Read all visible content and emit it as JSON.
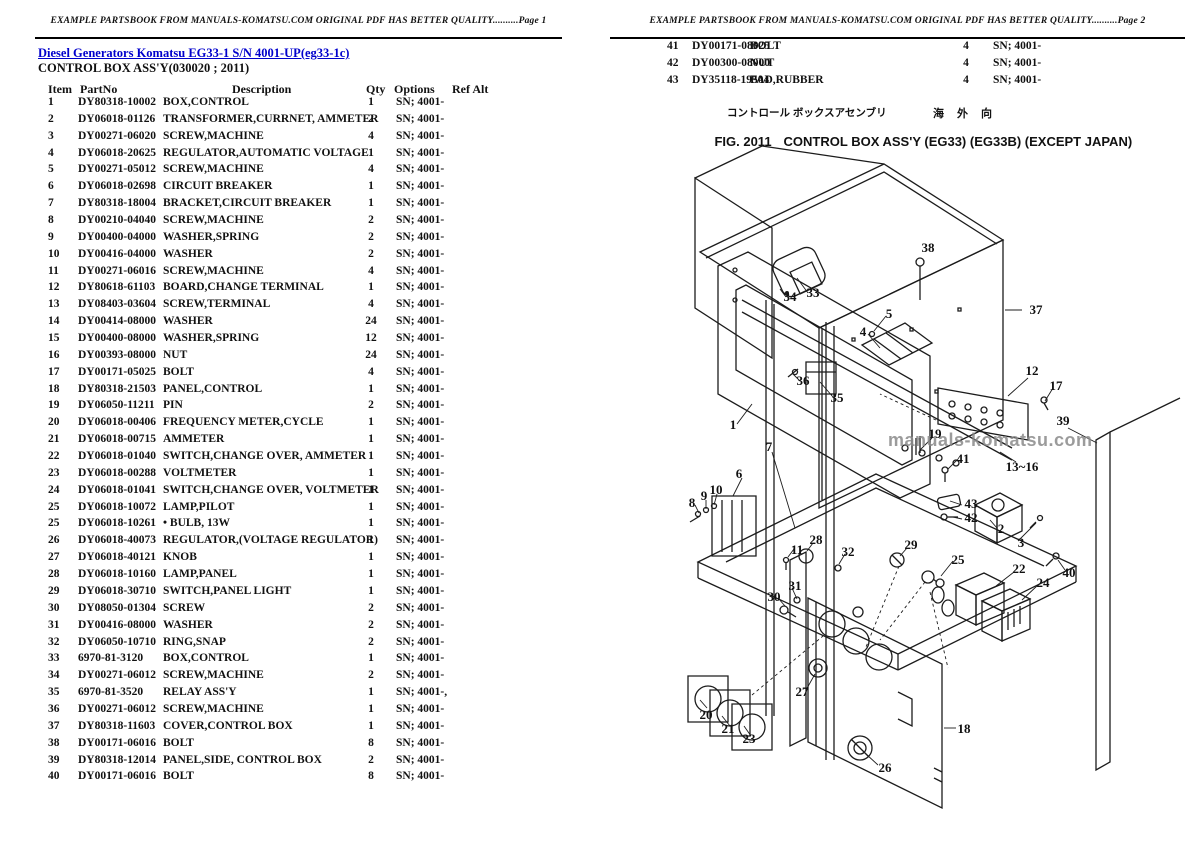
{
  "header_left": {
    "text": "EXAMPLE PARTSBOOK FROM MANUALS-KOMATSU.COM ORIGINAL PDF HAS BETTER QUALITY..........Page 1"
  },
  "header_right": {
    "text": "EXAMPLE PARTSBOOK FROM MANUALS-KOMATSU.COM ORIGINAL PDF HAS BETTER QUALITY..........Page 2"
  },
  "page1": {
    "title_link": "Diesel Generators Komatsu EG33-1 S/N 4001-UP(eg33-1c)",
    "subtitle": "CONTROL BOX ASS'Y(030020 ; 2011)",
    "columns": {
      "item": "Item",
      "partno": "PartNo",
      "description": "Description",
      "qty": "Qty",
      "options": "Options",
      "refalt": "Ref Alt"
    },
    "rows": [
      [
        "1",
        "DY80318-10002",
        "BOX,CONTROL",
        "1",
        "SN; 4001-"
      ],
      [
        "2",
        "DY06018-01126",
        "TRANSFORMER,CURRNET, AMMETER",
        "2",
        "SN; 4001-"
      ],
      [
        "3",
        "DY00271-06020",
        "SCREW,MACHINE",
        "4",
        "SN; 4001-"
      ],
      [
        "4",
        "DY06018-20625",
        "REGULATOR,AUTOMATIC VOLTAGE",
        "1",
        "SN; 4001-"
      ],
      [
        "5",
        "DY00271-05012",
        "SCREW,MACHINE",
        "4",
        "SN; 4001-"
      ],
      [
        "6",
        "DY06018-02698",
        "CIRCUIT BREAKER",
        "1",
        "SN; 4001-"
      ],
      [
        "7",
        "DY80318-18004",
        "BRACKET,CIRCUIT BREAKER",
        "1",
        "SN; 4001-"
      ],
      [
        "8",
        "DY00210-04040",
        "SCREW,MACHINE",
        "2",
        "SN; 4001-"
      ],
      [
        "9",
        "DY00400-04000",
        "WASHER,SPRING",
        "2",
        "SN; 4001-"
      ],
      [
        "10",
        "DY00416-04000",
        "WASHER",
        "2",
        "SN; 4001-"
      ],
      [
        "11",
        "DY00271-06016",
        "SCREW,MACHINE",
        "4",
        "SN; 4001-"
      ],
      [
        "12",
        "DY80618-61103",
        "BOARD,CHANGE TERMINAL",
        "1",
        "SN; 4001-"
      ],
      [
        "13",
        "DY08403-03604",
        "SCREW,TERMINAL",
        "4",
        "SN; 4001-"
      ],
      [
        "14",
        "DY00414-08000",
        "WASHER",
        "24",
        "SN; 4001-"
      ],
      [
        "15",
        "DY00400-08000",
        "WASHER,SPRING",
        "12",
        "SN; 4001-"
      ],
      [
        "16",
        "DY00393-08000",
        "NUT",
        "24",
        "SN; 4001-"
      ],
      [
        "17",
        "DY00171-05025",
        "BOLT",
        "4",
        "SN; 4001-"
      ],
      [
        "18",
        "DY80318-21503",
        "PANEL,CONTROL",
        "1",
        "SN; 4001-"
      ],
      [
        "19",
        "DY06050-11211",
        "PIN",
        "2",
        "SN; 4001-"
      ],
      [
        "20",
        "DY06018-00406",
        "FREQUENCY METER,CYCLE",
        "1",
        "SN; 4001-"
      ],
      [
        "21",
        "DY06018-00715",
        "AMMETER",
        "1",
        "SN; 4001-"
      ],
      [
        "22",
        "DY06018-01040",
        "SWITCH,CHANGE OVER, AMMETER",
        "1",
        "SN; 4001-"
      ],
      [
        "23",
        "DY06018-00288",
        "VOLTMETER",
        "1",
        "SN; 4001-"
      ],
      [
        "24",
        "DY06018-01041",
        "SWITCH,CHANGE OVER, VOLTMETER",
        "1",
        "SN; 4001-"
      ],
      [
        "25",
        "DY06018-10072",
        "LAMP,PILOT",
        "1",
        "SN; 4001-"
      ],
      [
        "25",
        "DY06018-10261",
        "• BULB, 13W",
        "1",
        "SN; 4001-"
      ],
      [
        "26",
        "DY06018-40073",
        "REGULATOR,(VOLTAGE REGULATOR)",
        "1",
        "SN; 4001-"
      ],
      [
        "27",
        "DY06018-40121",
        "KNOB",
        "1",
        "SN; 4001-"
      ],
      [
        "28",
        "DY06018-10160",
        "LAMP,PANEL",
        "1",
        "SN; 4001-"
      ],
      [
        "29",
        "DY06018-30710",
        "SWITCH,PANEL LIGHT",
        "1",
        "SN; 4001-"
      ],
      [
        "30",
        "DY08050-01304",
        "SCREW",
        "2",
        "SN; 4001-"
      ],
      [
        "31",
        "DY00416-08000",
        "WASHER",
        "2",
        "SN; 4001-"
      ],
      [
        "32",
        "DY06050-10710",
        "RING,SNAP",
        "2",
        "SN; 4001-"
      ],
      [
        "33",
        "6970-81-3120",
        "BOX,CONTROL",
        "1",
        "SN; 4001-"
      ],
      [
        "34",
        "DY00271-06012",
        "SCREW,MACHINE",
        "2",
        "SN; 4001-"
      ],
      [
        "35",
        "6970-81-3520",
        "RELAY ASS'Y",
        "1",
        "SN; 4001-,"
      ],
      [
        "36",
        "DY00271-06012",
        "SCREW,MACHINE",
        "1",
        "SN; 4001-"
      ],
      [
        "37",
        "DY80318-11603",
        "COVER,CONTROL BOX",
        "1",
        "SN; 4001-"
      ],
      [
        "38",
        "DY00171-06016",
        "BOLT",
        "8",
        "SN; 4001-"
      ],
      [
        "39",
        "DY80318-12014",
        "PANEL,SIDE, CONTROL BOX",
        "2",
        "SN; 4001-"
      ],
      [
        "40",
        "DY00171-06016",
        "BOLT",
        "8",
        "SN; 4001-"
      ]
    ]
  },
  "page2": {
    "rows": [
      [
        "41",
        "DY00171-08025",
        "BOLT",
        "4",
        "SN; 4001-"
      ],
      [
        "42",
        "DY00300-08000",
        "NUT",
        "4",
        "SN; 4001-"
      ],
      [
        "43",
        "DY35118-19504",
        "PAD,RUBBER",
        "4",
        "SN; 4001-"
      ]
    ],
    "figure": {
      "caption_jp_left": "コントロール ボックスアセンブリ",
      "caption_jp_right": "海外向",
      "fig_label": "FIG. 2011",
      "fig_title": "CONTROL BOX ASS'Y (EG33) (EG33B) (EXCEPT JAPAN)",
      "watermark": "manuals-komatsu.com",
      "callouts": [
        {
          "label": "38",
          "x": 928,
          "y": 252
        },
        {
          "label": "37",
          "x": 1036,
          "y": 314
        },
        {
          "label": "33",
          "x": 813,
          "y": 297
        },
        {
          "label": "34",
          "x": 790,
          "y": 301
        },
        {
          "label": "5",
          "x": 889,
          "y": 318
        },
        {
          "label": "4",
          "x": 863,
          "y": 336
        },
        {
          "label": "36",
          "x": 803,
          "y": 385
        },
        {
          "label": "35",
          "x": 837,
          "y": 402
        },
        {
          "label": "12",
          "x": 1032,
          "y": 375
        },
        {
          "label": "17",
          "x": 1056,
          "y": 390
        },
        {
          "label": "1",
          "x": 733,
          "y": 429
        },
        {
          "label": "39",
          "x": 1063,
          "y": 425
        },
        {
          "label": "19",
          "x": 935,
          "y": 438
        },
        {
          "label": "41",
          "x": 963,
          "y": 463
        },
        {
          "label": "13~16",
          "x": 1022,
          "y": 471
        },
        {
          "label": "7",
          "x": 769,
          "y": 451
        },
        {
          "label": "6",
          "x": 739,
          "y": 478
        },
        {
          "label": "9",
          "x": 704,
          "y": 500
        },
        {
          "label": "10",
          "x": 716,
          "y": 494
        },
        {
          "label": "8",
          "x": 692,
          "y": 507
        },
        {
          "label": "11",
          "x": 797,
          "y": 554
        },
        {
          "label": "28",
          "x": 816,
          "y": 544
        },
        {
          "label": "32",
          "x": 848,
          "y": 556
        },
        {
          "label": "29",
          "x": 911,
          "y": 549
        },
        {
          "label": "25",
          "x": 958,
          "y": 564
        },
        {
          "label": "43",
          "x": 971,
          "y": 508
        },
        {
          "label": "42",
          "x": 971,
          "y": 522
        },
        {
          "label": "2",
          "x": 1001,
          "y": 533
        },
        {
          "label": "3",
          "x": 1021,
          "y": 547
        },
        {
          "label": "22",
          "x": 1019,
          "y": 573
        },
        {
          "label": "24",
          "x": 1043,
          "y": 587
        },
        {
          "label": "40",
          "x": 1069,
          "y": 577
        },
        {
          "label": "30",
          "x": 774,
          "y": 601
        },
        {
          "label": "31",
          "x": 795,
          "y": 590
        },
        {
          "label": "27",
          "x": 802,
          "y": 696
        },
        {
          "label": "20",
          "x": 706,
          "y": 719
        },
        {
          "label": "21",
          "x": 728,
          "y": 733
        },
        {
          "label": "23",
          "x": 749,
          "y": 743
        },
        {
          "label": "26",
          "x": 885,
          "y": 772
        },
        {
          "label": "18",
          "x": 964,
          "y": 733
        }
      ]
    }
  },
  "colors": {
    "link_blue": "#0000cc",
    "ink": "#111111",
    "watermark_gray": "#8a8a8a"
  }
}
